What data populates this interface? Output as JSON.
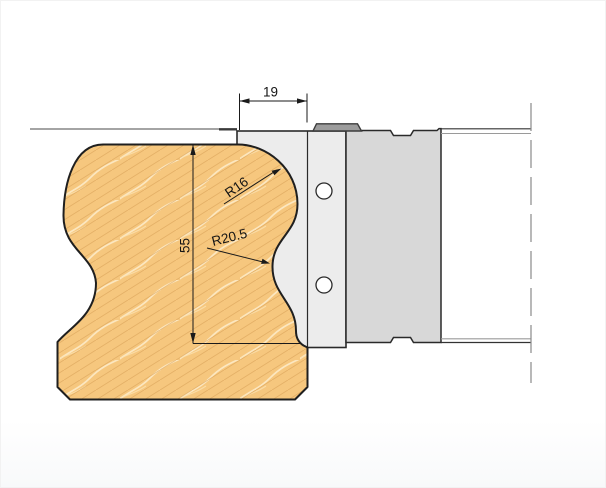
{
  "drawing": {
    "dim_width_label": "19",
    "dim_height_label": "55",
    "radius_top_label": "R16",
    "radius_cove_label": "R20.5",
    "colors": {
      "wood_fill": "#F6C77E",
      "wood_grain": "#D8A055",
      "wood_streak": "#FCE9C4",
      "knife_plate": "#ECECEC",
      "cutter_block": "#D8D8D8",
      "limiter_tab": "#9C9C9C",
      "outline": "#1F1F1F",
      "centerline": "#8A8A8A",
      "dimension": "#1A1A1A"
    }
  }
}
